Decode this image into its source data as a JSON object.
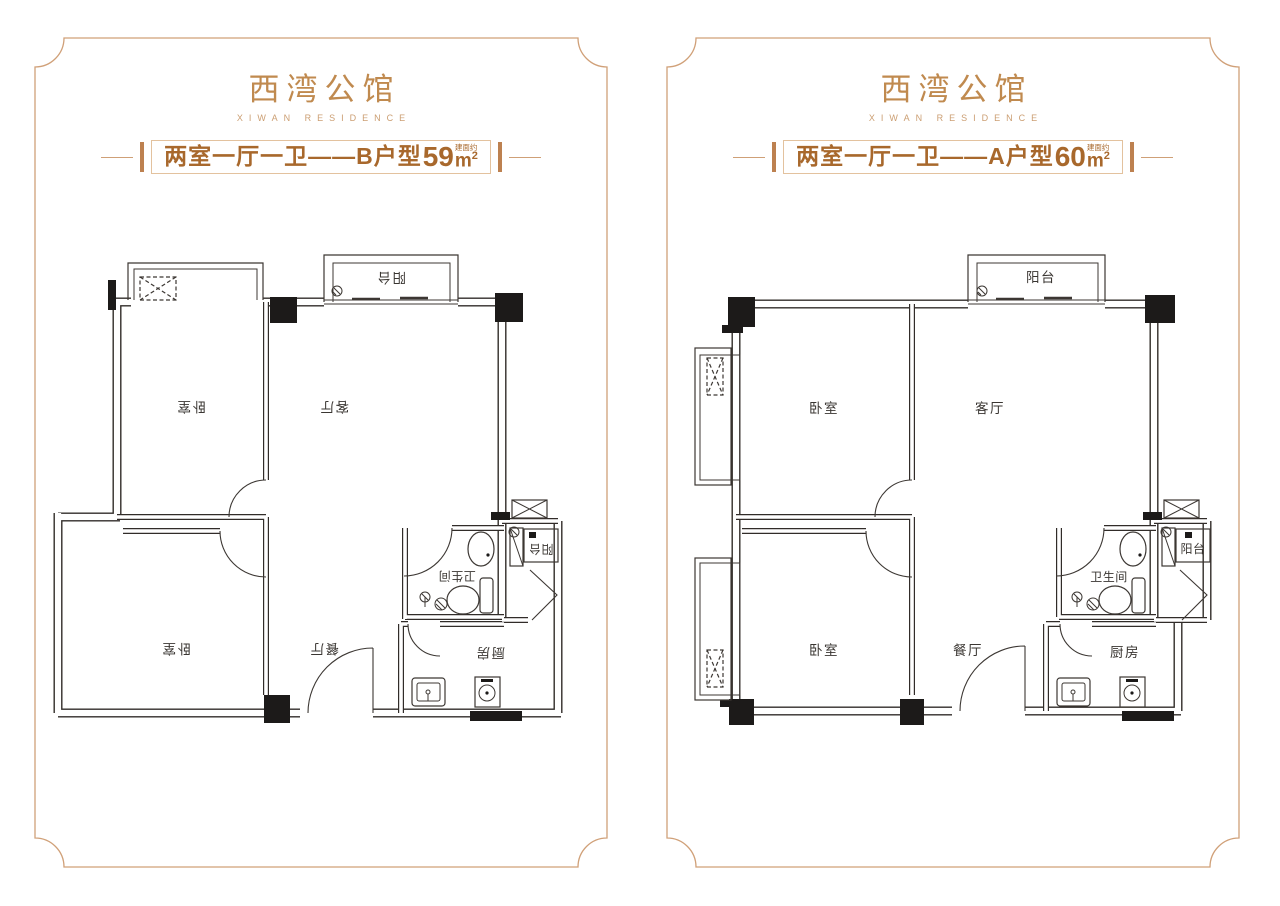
{
  "colors": {
    "frame": "#d0a078",
    "brand": "#c08a4f",
    "title_text": "#a8682c",
    "wall": "#312c29"
  },
  "panels": [
    {
      "logo": "西湾公馆",
      "logo_en": "XIWAN RESIDENCE",
      "title_main": "两室一厅一卫——B户型",
      "area_value": "59",
      "area_note": "建面约",
      "area_unit": "m",
      "area_sup": "2",
      "rooms": {
        "bedroom_top": "卧室",
        "living": "客厅",
        "bedroom_bottom": "卧室",
        "dining": "餐厅",
        "bathroom": "卫生间",
        "kitchen": "厨房",
        "balcony_top": "阳台",
        "balcony_side": "阳台"
      }
    },
    {
      "logo": "西湾公馆",
      "logo_en": "XIWAN RESIDENCE",
      "title_main": "两室一厅一卫——A户型",
      "area_value": "60",
      "area_note": "建面约",
      "area_unit": "m",
      "area_sup": "2",
      "rooms": {
        "bedroom_top": "卧室",
        "living": "客厅",
        "bedroom_bottom": "卧室",
        "dining": "餐厅",
        "bathroom": "卫生间",
        "kitchen": "厨房",
        "balcony_top": "阳台",
        "balcony_side": "阳台"
      }
    }
  ]
}
